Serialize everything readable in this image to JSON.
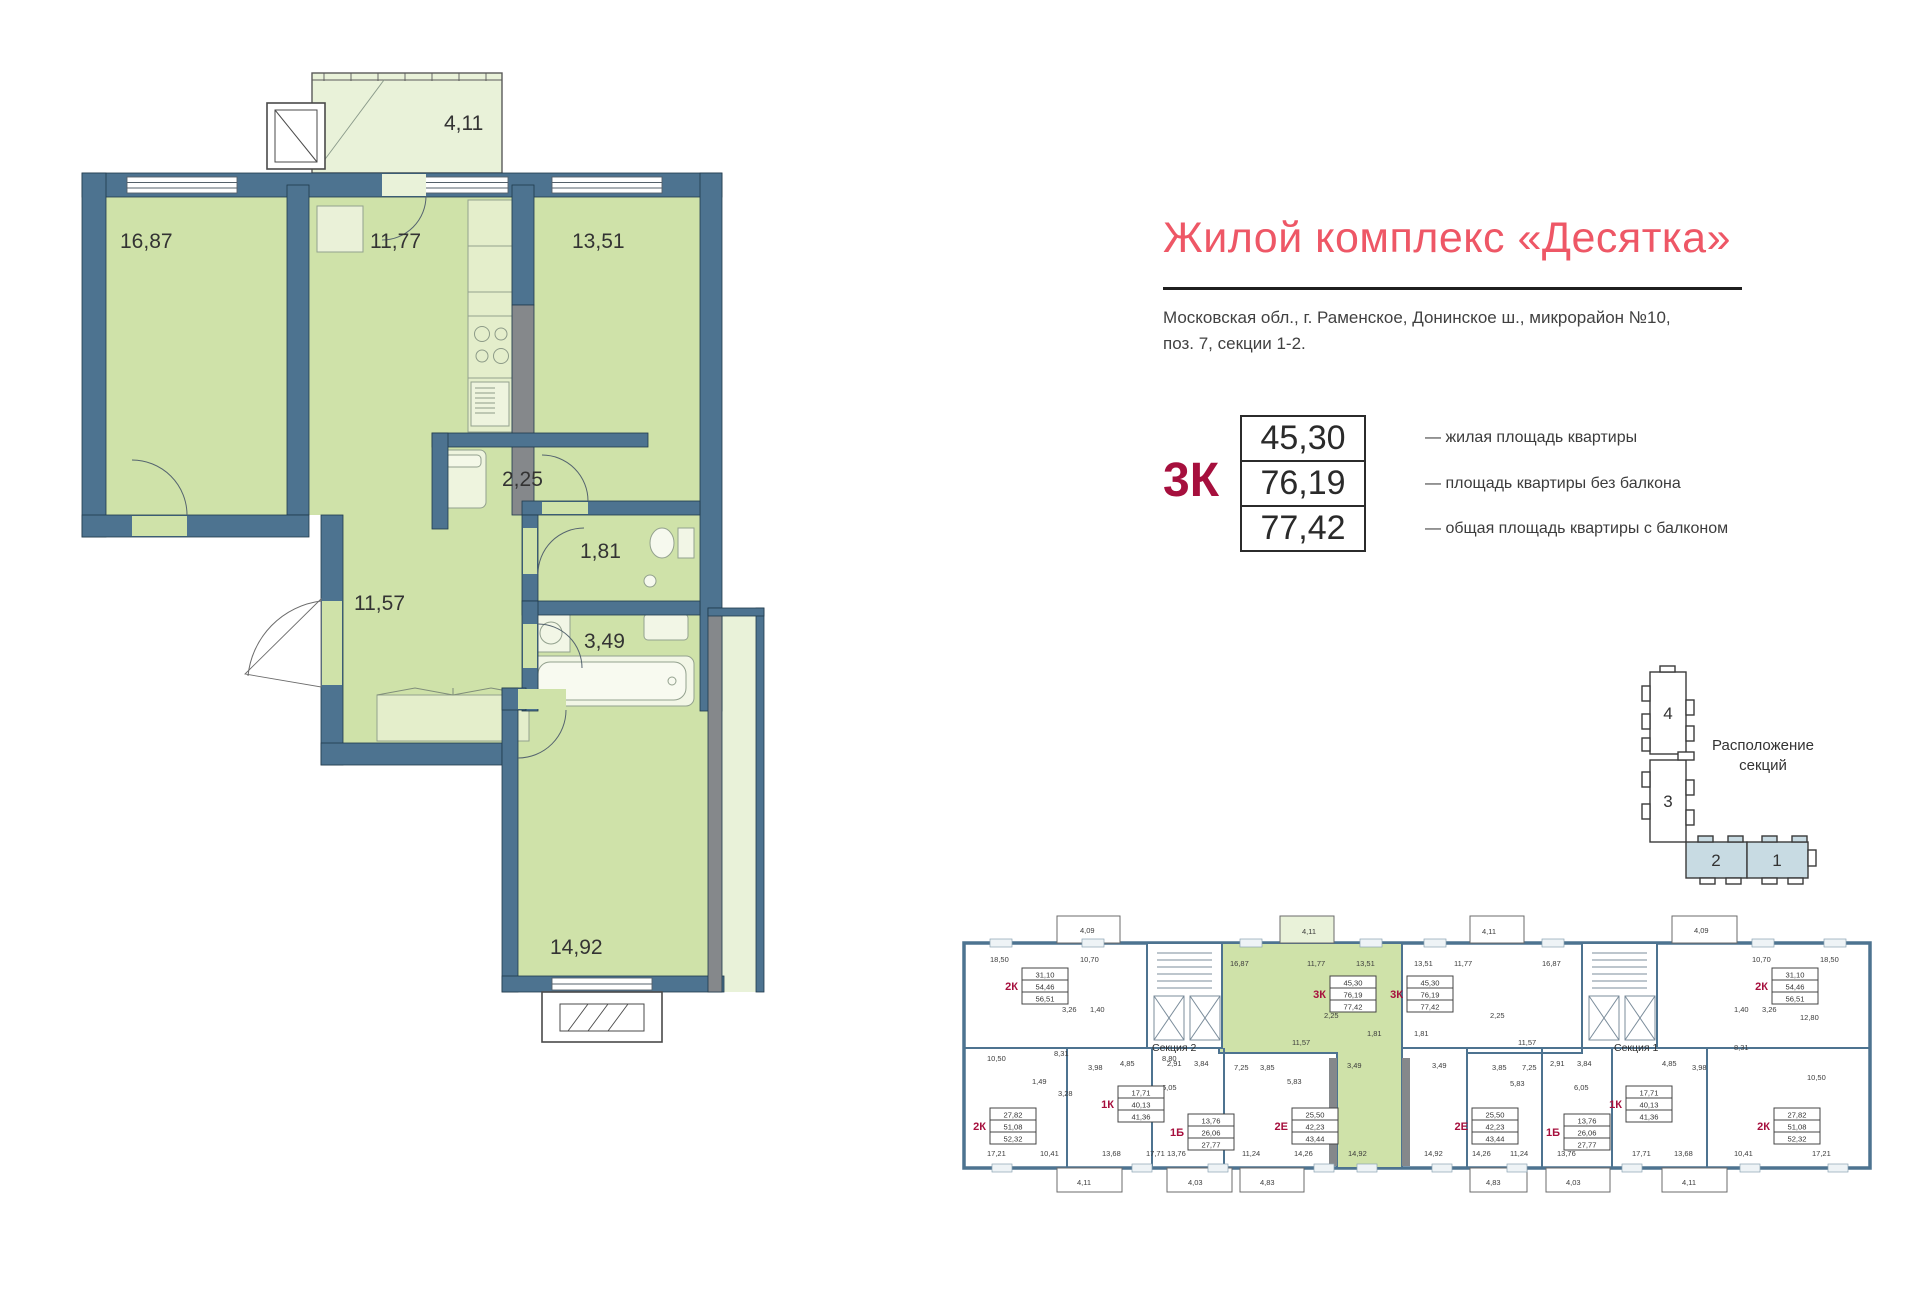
{
  "header": {
    "title": "Жилой комплекс «Десятка»",
    "address": [
      "Московская обл., г. Раменское, Донинское ш., микрорайон №10,",
      "поз. 7, секции 1-2."
    ]
  },
  "summary": {
    "type": "3К",
    "rows": [
      {
        "value": "45,30",
        "label": "— жилая площадь квартиры"
      },
      {
        "value": "76,19",
        "label": "— площадь квартиры без балкона"
      },
      {
        "value": "77,42",
        "label": "— общая площадь квартиры с балконом"
      }
    ]
  },
  "floor_plan": {
    "rooms": {
      "living": "16,87",
      "kitchen": "11,77",
      "bedroom2": "13,51",
      "balcony": "4,11",
      "storage": "2,25",
      "wc": "1,81",
      "hall": "11,57",
      "bath": "3,49",
      "bedroom1": "14,92"
    }
  },
  "sections_diagram": {
    "caption": [
      "Расположение",
      "секций"
    ],
    "blocks": [
      "4",
      "3",
      "2",
      "1"
    ]
  },
  "building_plan": {
    "section_labels": {
      "s2": "Секция 2",
      "s1": "Секция 1"
    },
    "apartments": [
      {
        "type": "2К",
        "areas": [
          "31,10",
          "54,46",
          "56,51"
        ]
      },
      {
        "type": "3К",
        "areas": [
          "45,30",
          "76,19",
          "77,42"
        ]
      },
      {
        "type": "3К",
        "areas": [
          "45,30",
          "76,19",
          "77,42"
        ]
      },
      {
        "type": "2К",
        "areas": [
          "31,10",
          "54,46",
          "56,51"
        ]
      },
      {
        "type": "2К",
        "areas": [
          "27,82",
          "51,08",
          "52,32"
        ]
      },
      {
        "type": "1К",
        "areas": [
          "17,71",
          "40,13",
          "41,36"
        ]
      },
      {
        "type": "1Б",
        "areas": [
          "13,76",
          "26,06",
          "27,77"
        ]
      },
      {
        "type": "2Е",
        "areas": [
          "25,50",
          "42,23",
          "43,44"
        ]
      },
      {
        "type": "2Е",
        "areas": [
          "25,50",
          "42,23",
          "43,44"
        ]
      },
      {
        "type": "1Б",
        "areas": [
          "13,76",
          "26,06",
          "27,77"
        ]
      },
      {
        "type": "1К",
        "areas": [
          "17,71",
          "40,13",
          "41,36"
        ]
      },
      {
        "type": "2К",
        "areas": [
          "27,82",
          "51,08",
          "52,32"
        ]
      }
    ],
    "room_labels": {
      "t2kl_1850": "18,50",
      "t2kl_1070": "10,70",
      "balc409l": "4,09",
      "g_1687": "16,87",
      "g_1177": "11,77",
      "g_1351": "13,51",
      "balc411g": "4,11",
      "w_1351": "13,51",
      "w_1177": "11,77",
      "w_1687": "16,87",
      "balc411w": "4,11",
      "t2kr_1070": "10,70",
      "t2kr_1850": "18,50",
      "balc409r": "4,09",
      "g_1157": "11,57",
      "g_225": "2,25",
      "g_181": "1,81",
      "g_349": "3,49",
      "g_1492": "14,92",
      "w_181": "1,81",
      "w_349": "3,49",
      "w_1157": "11,57",
      "w_225": "2,25",
      "w_1492": "14,92",
      "s2_880": "8,80",
      "b2kl_1050": "10,50",
      "b2kl_831": "8,31",
      "b2kl_326": "3,26",
      "b2kl_140": "1,40",
      "b2kl_149": "1,49",
      "b2kl_328": "3,28",
      "b2kl_1721": "17,21",
      "b2kl_1041": "10,41",
      "b1kl_398": "3,98",
      "b1kl_485": "4,85",
      "b1kl_1368": "13,68",
      "b1kl_1771": "17,71",
      "b1bl_291": "2,91",
      "b1bl_384": "3,84",
      "b1bl_605": "6,05",
      "b1bl_1376": "13,76",
      "b2el_725": "7,25",
      "b2el_385": "3,85",
      "b2el_583": "5,83",
      "b2el_1124": "11,24",
      "b2el_1426": "14,26",
      "b2er_1426": "14,26",
      "b2er_1124": "11,24",
      "b2er_583": "5,83",
      "b2er_385": "3,85",
      "b2er_725": "7,25",
      "b1br_1376": "13,76",
      "b1br_605": "6,05",
      "b1br_291": "2,91",
      "b1br_384": "3,84",
      "b1kr_1771": "17,71",
      "b1kr_1368": "13,68",
      "b1kr_485": "4,85",
      "b1kr_398": "3,98",
      "b2kr_1721": "17,21",
      "b2kr_1041": "10,41",
      "b2kr_1050": "10,50",
      "b2kr_1280": "12,80",
      "b2kr_831": "8,31",
      "b2kr_326": "3,26",
      "b2kr_140": "1,40",
      "bb_411l": "4,11",
      "bb_403l": "4,03",
      "bb_483l": "4,83",
      "bb_483r": "4,83",
      "bb_403r": "4,03",
      "bb_411r": "4,11"
    }
  },
  "colors": {
    "accent": "#ee5766",
    "apartment_type": "#a60f3d",
    "floor": "#cfe2a9",
    "balcony_floor": "#e9f2d9",
    "wall": "#4d7390",
    "gray_wall": "#85888b",
    "section_fill": "#c8dbe3"
  }
}
